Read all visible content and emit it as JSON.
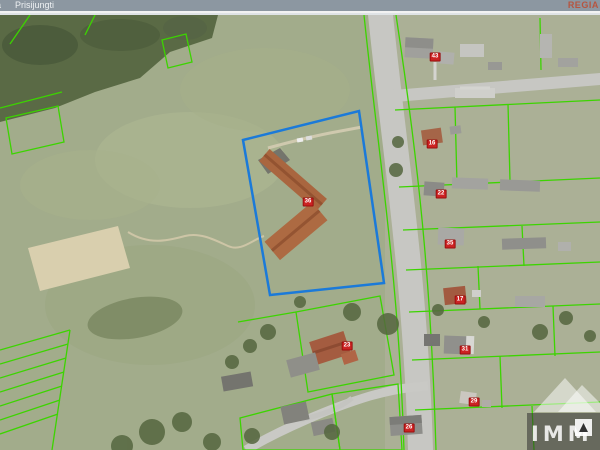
{
  "header": {
    "menu_items": [
      {
        "label": "a"
      },
      {
        "label": "Prisijungti"
      }
    ],
    "brand": "REGIA V"
  },
  "map": {
    "labels": [
      {
        "text": "43",
        "x": 435,
        "y": 42
      },
      {
        "text": "16",
        "x": 432,
        "y": 129
      },
      {
        "text": "22",
        "x": 441,
        "y": 179
      },
      {
        "text": "36",
        "x": 308,
        "y": 187
      },
      {
        "text": "35",
        "x": 450,
        "y": 229
      },
      {
        "text": "17",
        "x": 460,
        "y": 285
      },
      {
        "text": "23",
        "x": 347,
        "y": 331
      },
      {
        "text": "31",
        "x": 465,
        "y": 335
      },
      {
        "text": "29",
        "x": 474,
        "y": 387
      },
      {
        "text": "26",
        "x": 409,
        "y": 413
      }
    ],
    "colors": {
      "parcel_outline": "#3cd400",
      "selected_parcel": "#1b7ad9",
      "building_label_bg": "#cc2222",
      "building_label_text": "#ffffff"
    }
  },
  "watermark": {
    "text": "IMM"
  }
}
